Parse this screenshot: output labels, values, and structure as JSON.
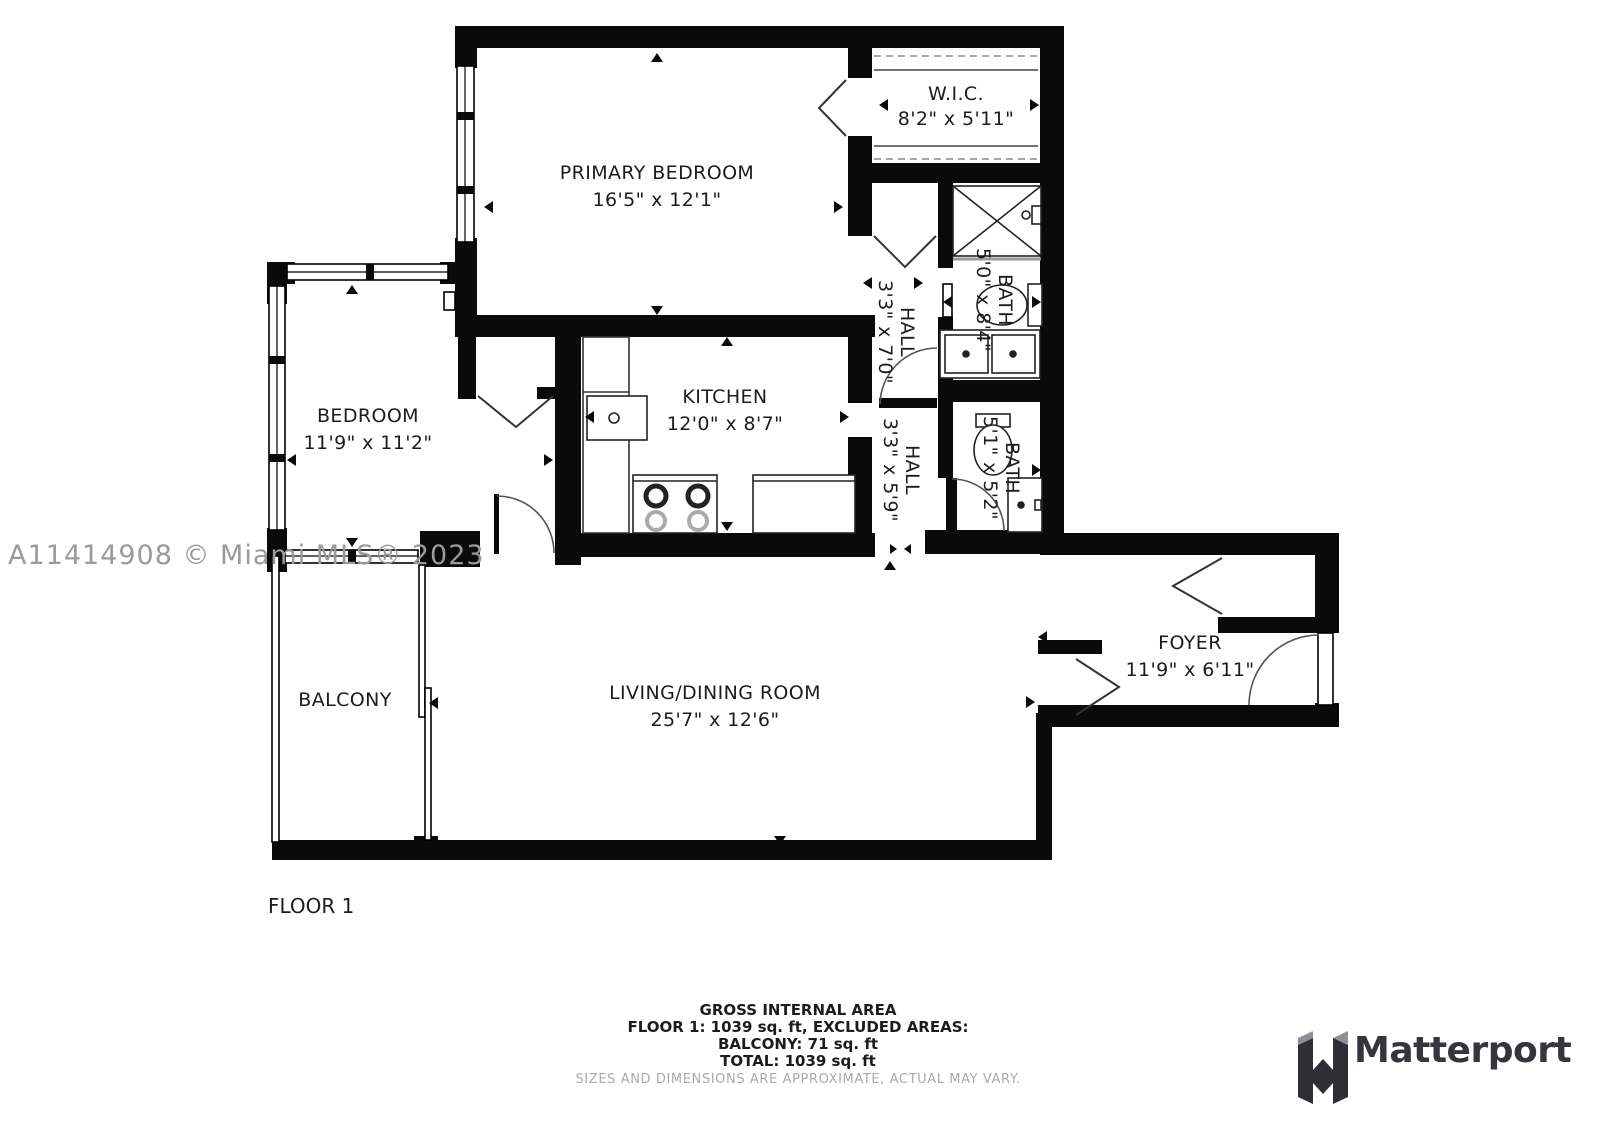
{
  "floor_plan": {
    "rooms": {
      "wic": {
        "name": "W.I.C.",
        "dims": "8'2\" x 5'11\""
      },
      "primary_bedroom": {
        "name": "PRIMARY BEDROOM",
        "dims": "16'5\" x 12'1\""
      },
      "bedroom": {
        "name": "BEDROOM",
        "dims": "11'9\" x 11'2\""
      },
      "kitchen": {
        "name": "KITCHEN",
        "dims": "12'0\" x 8'7\""
      },
      "hall_upper": {
        "name": "HALL",
        "dims": "3'3\" x 7'0\""
      },
      "bath_upper": {
        "name": "BATH",
        "dims": "5'0\" x 8'4\""
      },
      "hall_lower": {
        "name": "HALL",
        "dims": "3'3\" x 5'9\""
      },
      "bath_lower": {
        "name": "BATH",
        "dims": "5'1\" x 5'2\""
      },
      "living_dining": {
        "name": "LIVING/DINING ROOM",
        "dims": "25'7\" x 12'6\""
      },
      "balcony": {
        "name": "BALCONY"
      },
      "foyer": {
        "name": "FOYER",
        "dims": "11'9\" x 6'11\""
      }
    },
    "floor_label": "FLOOR 1",
    "watermark": "A11414908 © Miami MLS® 2023"
  },
  "footer": {
    "line1": "GROSS INTERNAL AREA",
    "line2": "FLOOR 1: 1039 sq. ft, EXCLUDED AREAS:",
    "line3": "BALCONY: 71 sq. ft",
    "line4": "TOTAL: 1039 sq. ft",
    "disclaimer": "SIZES AND DIMENSIONS ARE APPROXIMATE, ACTUAL MAY VARY."
  },
  "branding": {
    "logo_text": "Matterport"
  },
  "colors": {
    "wall": "#0a0a0a",
    "label": "#1c1c1c",
    "watermark": "#9a9a9a",
    "disclaimer": "#aaaaaa",
    "logo": "#35353b",
    "glass": "#999999"
  }
}
